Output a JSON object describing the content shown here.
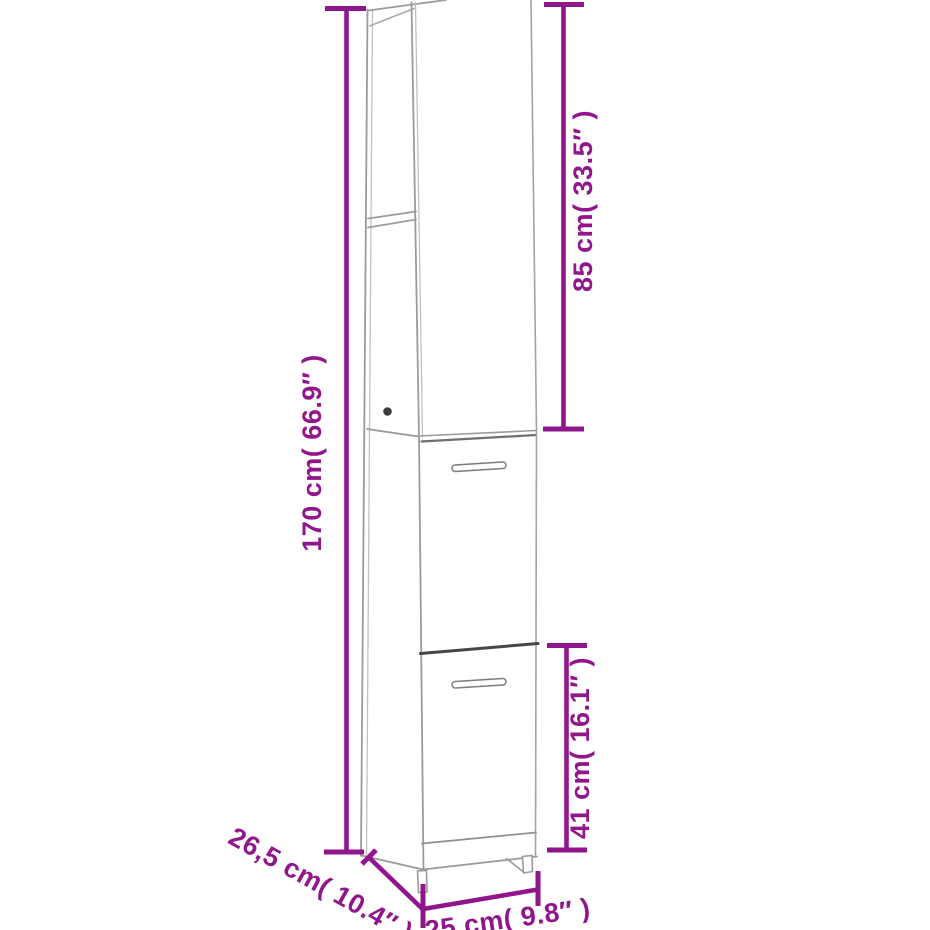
{
  "canvas": {
    "width": 930,
    "height": 930,
    "background": "#ffffff"
  },
  "diagram": {
    "kind": "furniture-dimension-diagram",
    "subject": "tall narrow bathroom cabinet line drawing, perspective view, open top shelves and two doors with handles",
    "accent_color": "#91168C",
    "outline_color": "#9B9B9B",
    "dimensions": [
      {
        "id": "total_height",
        "label": "170 cm( 66.9″ )",
        "cm": 170,
        "inch": 66.9,
        "placement": "vertical-left"
      },
      {
        "id": "upper_section_height",
        "label": "85 cm( 33.5″ )",
        "cm": 85,
        "inch": 33.5,
        "placement": "vertical-right-top"
      },
      {
        "id": "lower_door_height",
        "label": "41 cm( 16.1″ )",
        "cm": 41,
        "inch": 16.1,
        "placement": "vertical-right-bottom"
      },
      {
        "id": "depth",
        "label": "26,5 cm( 10.4″ )",
        "cm": 26.5,
        "inch": 10.4,
        "placement": "diagonal-bottom-left"
      },
      {
        "id": "width",
        "label": "25 cm( 9.8″ )",
        "cm": 25,
        "inch": 9.8,
        "placement": "bottom"
      }
    ]
  }
}
